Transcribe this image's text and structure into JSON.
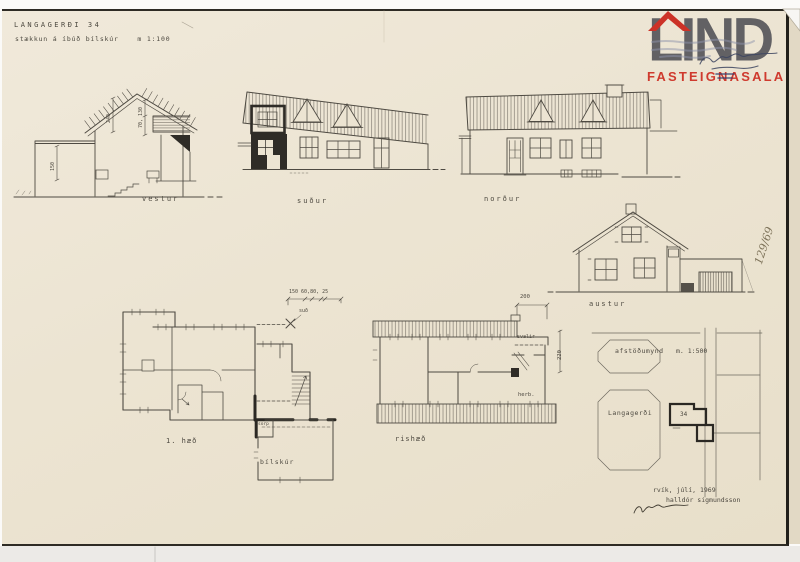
{
  "sheet": {
    "title": "LANGAGERÐI  34",
    "subtitle": "stækkun á íbúð  bílskúr",
    "scale": "m 1:100",
    "sheet_number": "129/69",
    "date": "rvík, júlí, 1969",
    "architect": "halldór sigmundsson"
  },
  "logo": {
    "brand": "LIND",
    "tagline": "FASTEIGNASALA",
    "accent_color": "#cc3227",
    "letter_color": "#58585c"
  },
  "elevations": {
    "west": "vestur",
    "south": "suður",
    "north": "norður",
    "east": "austur"
  },
  "plans": {
    "first_floor": "1. hæð",
    "attic": "rishæð",
    "garage": "bílskúr",
    "waste_room": "sorp",
    "balcony": "svalir",
    "room": "herb.",
    "window_note": "suð"
  },
  "site_plan": {
    "label": "afstöðumynd",
    "scale": "m. 1:500",
    "street": "Langagerði",
    "plot_number": "34"
  },
  "dimensions": {
    "extension_height": "150",
    "gable_height": "240",
    "gable_upper": "70, 130",
    "plan_widths": "150  60,80, 25",
    "balcony_width": "200",
    "attic_depth": "220"
  },
  "colors": {
    "paper": "#ece4d2",
    "ink": "#4a463e"
  }
}
